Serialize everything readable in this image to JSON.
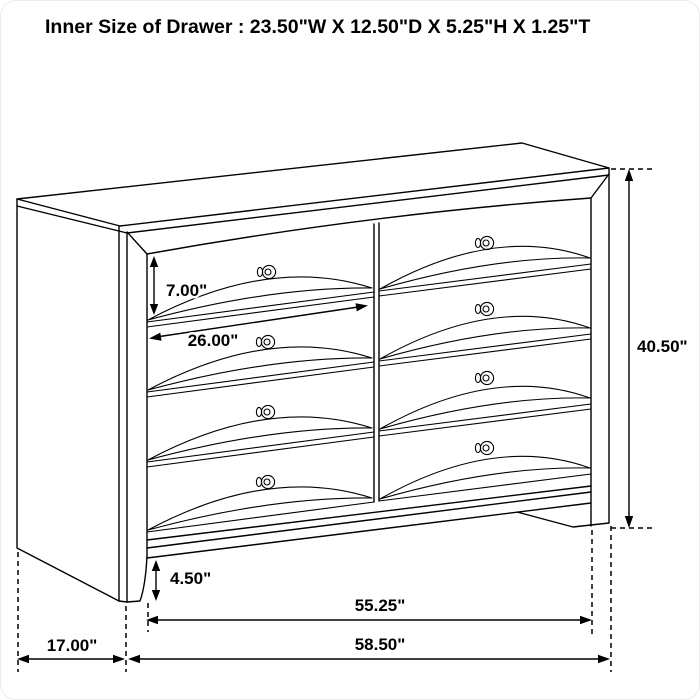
{
  "page": {
    "background": "#ffffff",
    "frame_border": "#ececec",
    "line_color": "#000000",
    "text_color": "#000000"
  },
  "title": "Inner Size of Drawer : 23.50\"W X 12.50\"D X 5.25\"H X 1.25\"T",
  "diagram": {
    "subject": "eight-drawer-dresser-dimension-drawing",
    "dimensions": {
      "drawer_front_height": "7.00\"",
      "drawer_front_width": "26.00\"",
      "overall_height": "40.50\"",
      "base_clearance_height": "4.50\"",
      "front_width_between_feet": "55.25\"",
      "side_depth": "17.00\"",
      "overall_width": "58.50\""
    }
  }
}
